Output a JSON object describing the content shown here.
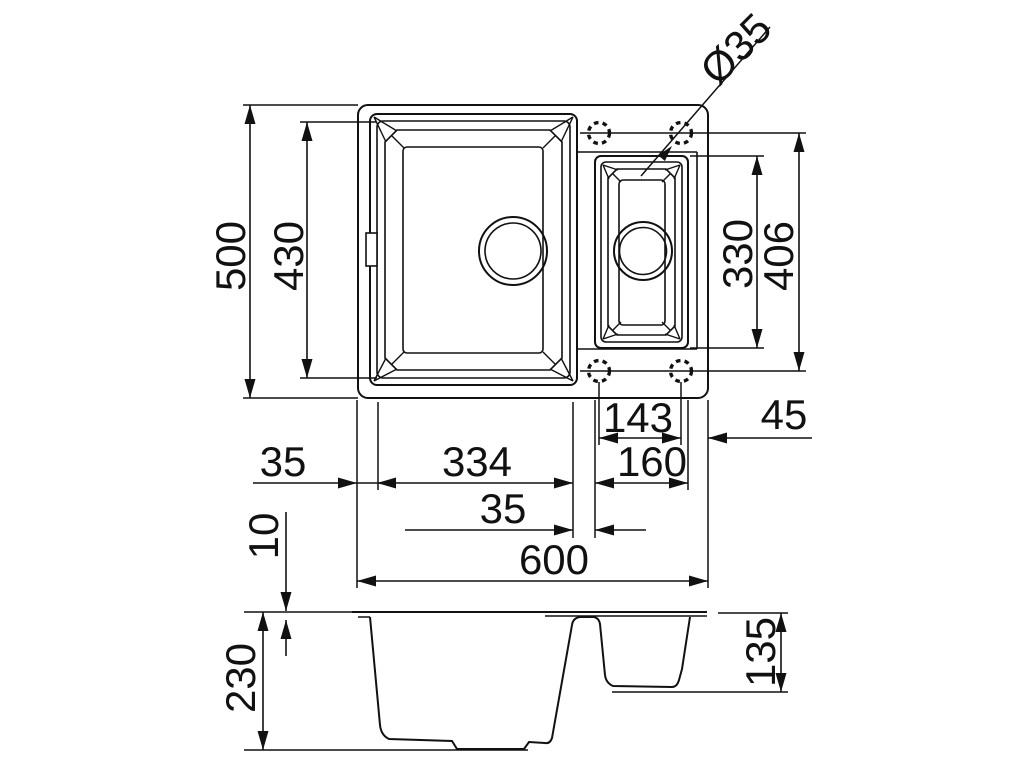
{
  "drawing": {
    "type": "technical-dimension-drawing",
    "subject": "kitchen sink with main bowl and half bowl",
    "views": [
      "top-view",
      "side-section-view"
    ],
    "units": "mm"
  },
  "labels": {
    "hole_diameter": "Ø35",
    "overall_depth": "500",
    "bowl_length": "430",
    "half_bowl_length": "330",
    "tap_span_depth": "406",
    "tap_span_width": "143",
    "edge_to_tap": "45",
    "left_rim": "35",
    "bowl_width": "334",
    "half_bowl_width": "160",
    "bowl_gap": "35",
    "overall_width": "600",
    "rim_thickness": "10",
    "total_height": "230",
    "half_bowl_height": "135"
  }
}
